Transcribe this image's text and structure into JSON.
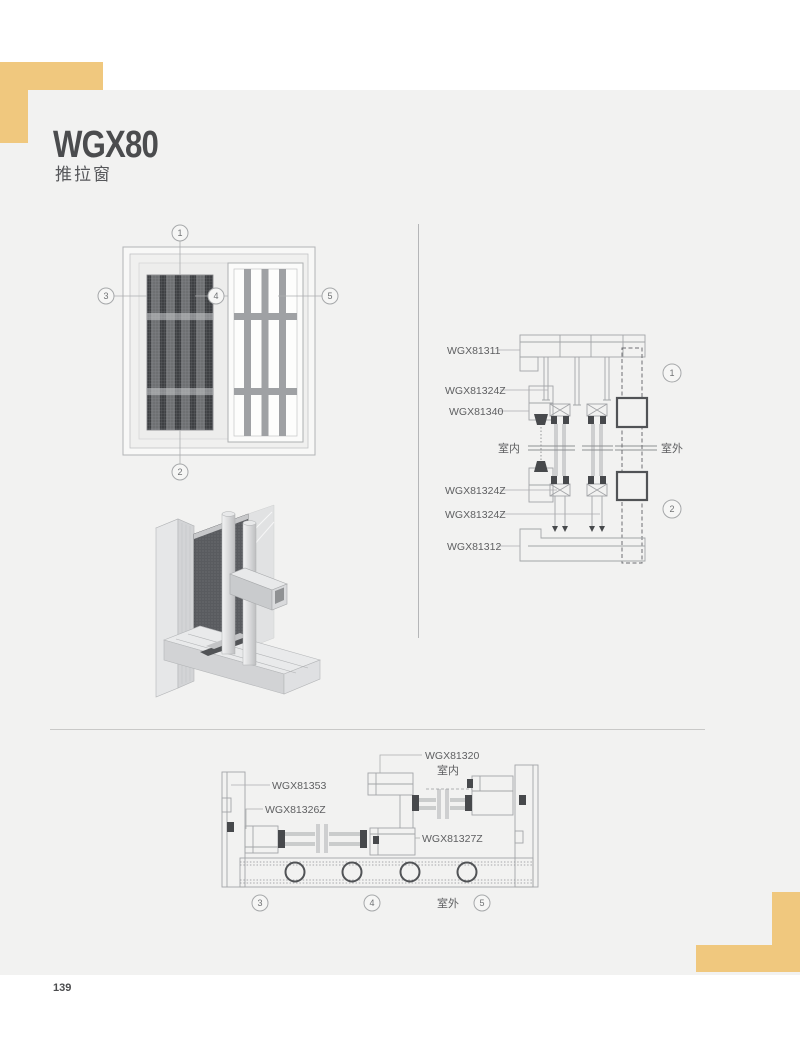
{
  "page": {
    "title": "WGX80",
    "subtitle": "推拉窗",
    "page_number": "139"
  },
  "colors": {
    "accent_yellow": "#F0C87E",
    "sheet_bg": "#F2F2F1",
    "outer_bg": "#FFFFFF",
    "title_text": "#4B4C4E",
    "label_text": "#5E5F61",
    "drawing_line": "#A3A5A8",
    "drawing_dark": "#47494C",
    "mesh_dark": "#3E4043"
  },
  "elevation": {
    "callouts": [
      "1",
      "2",
      "3",
      "4",
      "5"
    ]
  },
  "vertical_section": {
    "labels": {
      "l1": "WGX81311",
      "l2": "WGX81324Z",
      "l3": "WGX81340",
      "l4": "WGX81324Z",
      "l5": "WGX81324Z",
      "l6": "WGX81312"
    },
    "indoor": "室内",
    "outdoor": "室外",
    "callouts": [
      "1",
      "2"
    ]
  },
  "horizontal_section": {
    "labels": {
      "l1": "WGX81320",
      "l2": "WGX81353",
      "l3": "WGX81326Z",
      "l4": "WGX81327Z"
    },
    "indoor": "室内",
    "outdoor": "室外",
    "callouts": [
      "3",
      "4",
      "5"
    ]
  }
}
